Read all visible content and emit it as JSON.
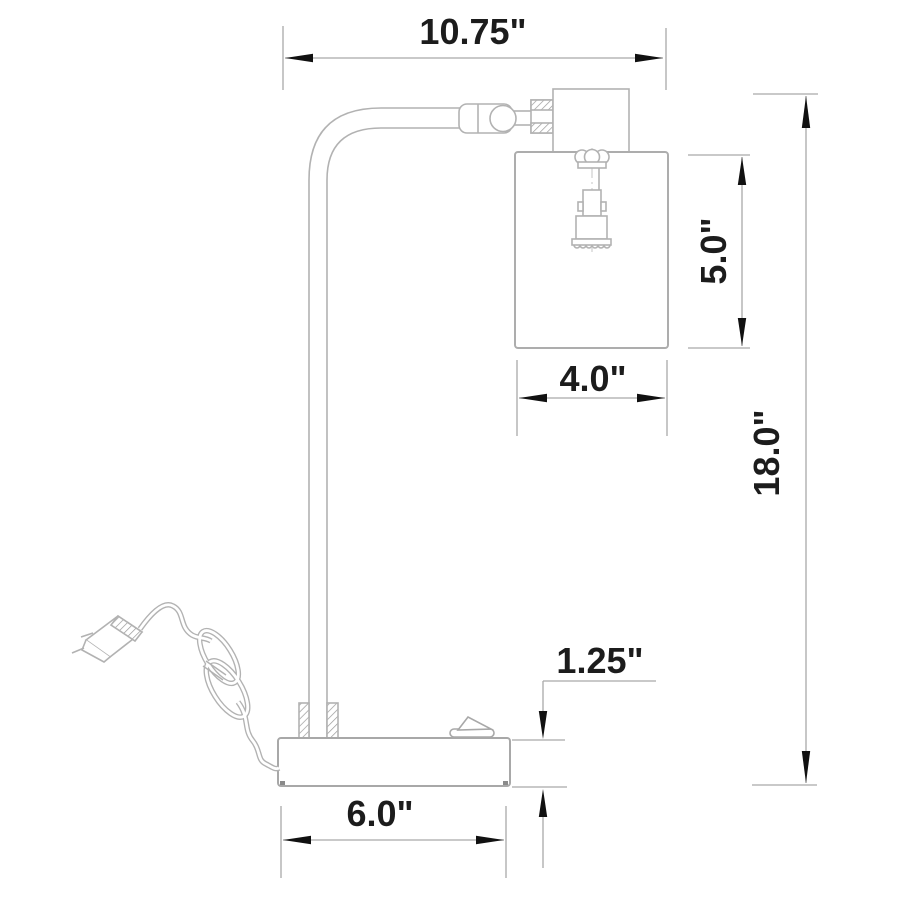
{
  "diagram": {
    "kind": "technical-dimension-drawing",
    "subject": "arc desk lamp with cylindrical metal shade, side elevation",
    "units": "inches",
    "background_color": "#ffffff",
    "colors": {
      "object_line": "#b2b2b2",
      "dimension_line": "#a9a9a9",
      "arrowhead": "#111111",
      "annotation_text": "#1c1c1c"
    },
    "labels": {
      "overall_width": "10.75\"",
      "shade_height": "5.0\"",
      "shade_width": "4.0\"",
      "overall_height": "18.0\"",
      "base_height": "1.25\"",
      "base_width": "6.0\""
    },
    "parts": [
      "two-prong-plug",
      "power-cord",
      "cord-coil",
      "rectangular-base",
      "toggle-switch",
      "pole-collar",
      "curved-pole-arm",
      "arm-joint-cylinder",
      "knurled-nut",
      "socket-housing",
      "bulb-socket",
      "cylindrical-shade"
    ]
  }
}
